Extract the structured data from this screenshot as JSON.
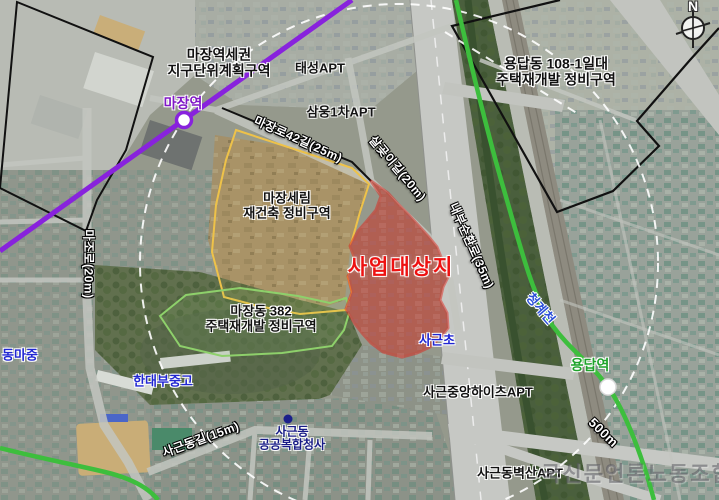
{
  "compass": {
    "north_label": "N"
  },
  "project_site": {
    "label": "사업대상지"
  },
  "district_labels": {
    "majang_station_area": {
      "line1": "마장역세권",
      "line2": "지구단위계획구역"
    },
    "yongdap_dong": {
      "line1": "용답동 108-1일대",
      "line2": "주택재개발 정비구역"
    },
    "majang_serim": {
      "line1": "마장세림",
      "line2": "재건축 정비구역"
    },
    "majang_382": {
      "line1": "마장동 382",
      "line2": "주택재개발 정비구역"
    }
  },
  "stations": {
    "majang": {
      "label": "마장역"
    },
    "yongdap": {
      "label": "용답역"
    }
  },
  "roads": {
    "majangro42": "마장로42길(25m)",
    "salgoji": "살곶이길(20m)",
    "naebu_ring": "내부순환로(35m)",
    "majoro": "마조로(20m)",
    "sageundong_gil": "사근동길(15m)"
  },
  "scale_label": "500m",
  "places": {
    "taeseong_apt": "태성APT",
    "samung_apt": "삼웅1차APT",
    "sageun_elementary": "사근초",
    "dongma_middle": "동마중",
    "handae_school": "한대부중고",
    "sageun_jungang_heights_apt": "사근중앙하이츠APT",
    "sageun_byeoksan_apt": "사근동벽산APT",
    "community_center_line1": "사근동",
    "community_center_line2": "공공복합청사",
    "cheonggyecheon": "청계천"
  },
  "watermark": "국신문언론노동조합",
  "colors": {
    "site_fill": "#d42b20",
    "site_border": "#e51b12",
    "subway_purple": "#8822dd",
    "subway_green": "#3dbe3d",
    "boundary_black": "#111111",
    "boundary_yellow": "#eec249",
    "boundary_green": "#8ed06b",
    "radius_dash": "#ffffff"
  }
}
